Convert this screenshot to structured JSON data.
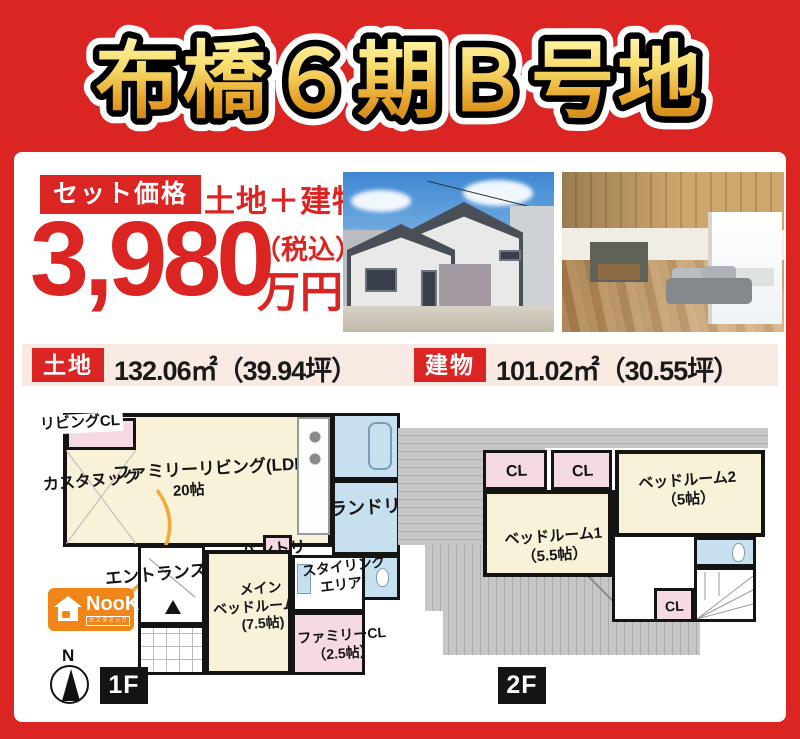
{
  "title": "布橋６期Ｂ号地",
  "colors": {
    "accent_red": "#DA2523",
    "title_gold_top": "#FFF6B0",
    "title_gold_bottom": "#C77F12",
    "logo_orange": "#F08519",
    "room_cream": "#F7F2D8",
    "closet_pink": "#F5D9E3",
    "wet_blue": "#C6E0EF",
    "roof_gray": "#C7C7C7",
    "area_bar_bg": "#F8EAE2"
  },
  "price": {
    "badge": "セット価格",
    "scope": "土地＋建物",
    "amount": "3,980",
    "tax_note": "（税込）",
    "unit": "万円"
  },
  "area_bar": {
    "land_badge": "土地",
    "land_value": "132.06㎡（39.94坪）",
    "building_badge": "建物",
    "building_value": "101.02㎡（30.55坪）"
  },
  "plan_1f": {
    "floor_label": "1F",
    "compass": "N",
    "living_cl": "リビングCL",
    "custom_nook": "カスタヌック",
    "ldk": "ファミリーリビング(LDK)",
    "ldk_size": "20帖",
    "laundry": "ランドリー",
    "pantry": "パントリー",
    "entrance": "エントランス",
    "main_bedroom_line1": "メイン",
    "main_bedroom_line2": "ベッドルーム",
    "main_bedroom_size": "(7.5帖)",
    "styling_line1": "スタイリング",
    "styling_line2": "エリア",
    "family_cl": "ファミリーCL",
    "family_cl_size": "（2.5帖）"
  },
  "plan_2f": {
    "floor_label": "2F",
    "cl_a": "CL",
    "cl_b": "CL",
    "cl_c": "CL",
    "bedroom2": "ベッドルーム2",
    "bedroom2_size": "（5帖）",
    "bedroom1": "ベッドルーム1",
    "bedroom1_size": "（5.5帖）"
  },
  "logo": {
    "brand": "NooK",
    "sub": "カスタヌック"
  }
}
